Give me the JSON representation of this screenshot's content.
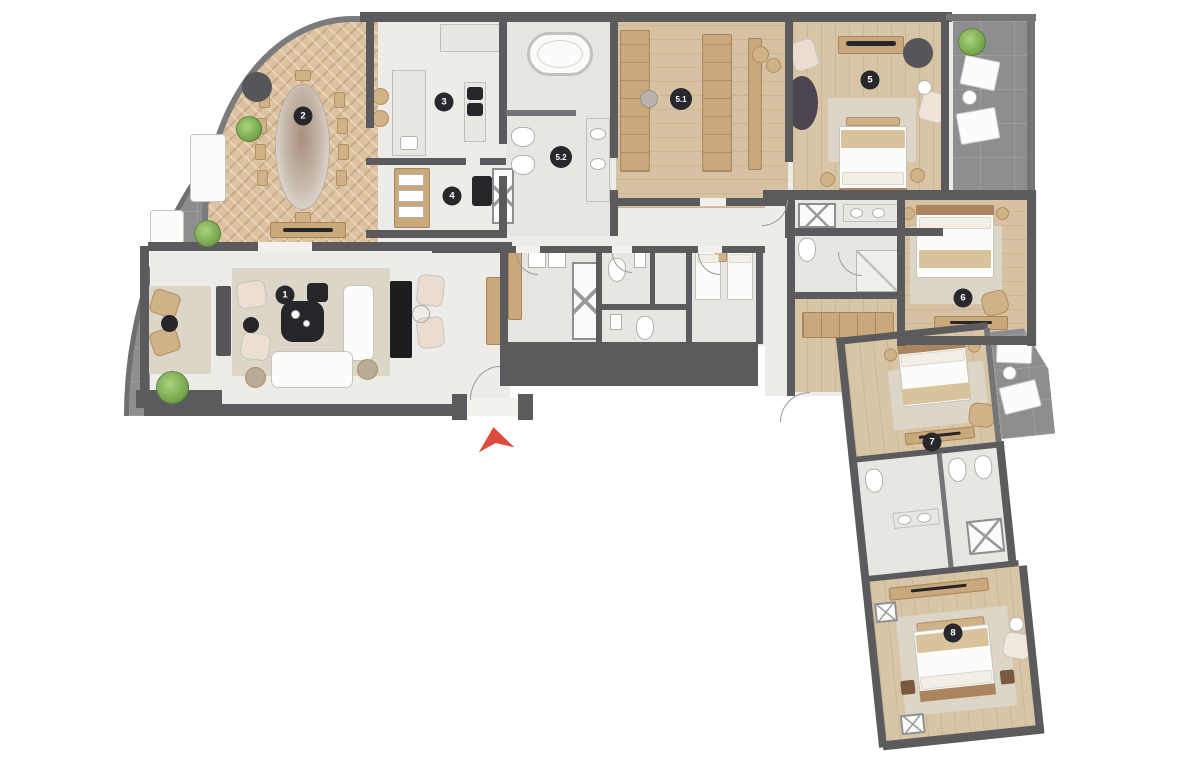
{
  "title": "apartment-floor-plan",
  "rooms": [
    {
      "label": "1",
      "name": "living-room"
    },
    {
      "label": "2",
      "name": "dining-room"
    },
    {
      "label": "3",
      "name": "kitchen"
    },
    {
      "label": "4",
      "name": "back-kitchen"
    },
    {
      "label": "5",
      "name": "master-bedroom"
    },
    {
      "label": "5.1",
      "name": "dressing-room"
    },
    {
      "label": "5.2",
      "name": "master-bathroom"
    },
    {
      "label": "6",
      "name": "bedroom-6"
    },
    {
      "label": "7",
      "name": "bedroom-7"
    },
    {
      "label": "8",
      "name": "bedroom-8"
    }
  ],
  "colors": {
    "wall": "#5b5b5d",
    "terrace": "#8d8e90",
    "wood": "#d8c5a6",
    "herringbone": "#dcc29e",
    "marble": "#edece8",
    "badge_bg": "#28282c",
    "badge_text": "#ffffff",
    "entrance_arrow": "#df4b3b",
    "plant": "#7fae53"
  },
  "entrance": {
    "marker": "red-arrow-up"
  }
}
